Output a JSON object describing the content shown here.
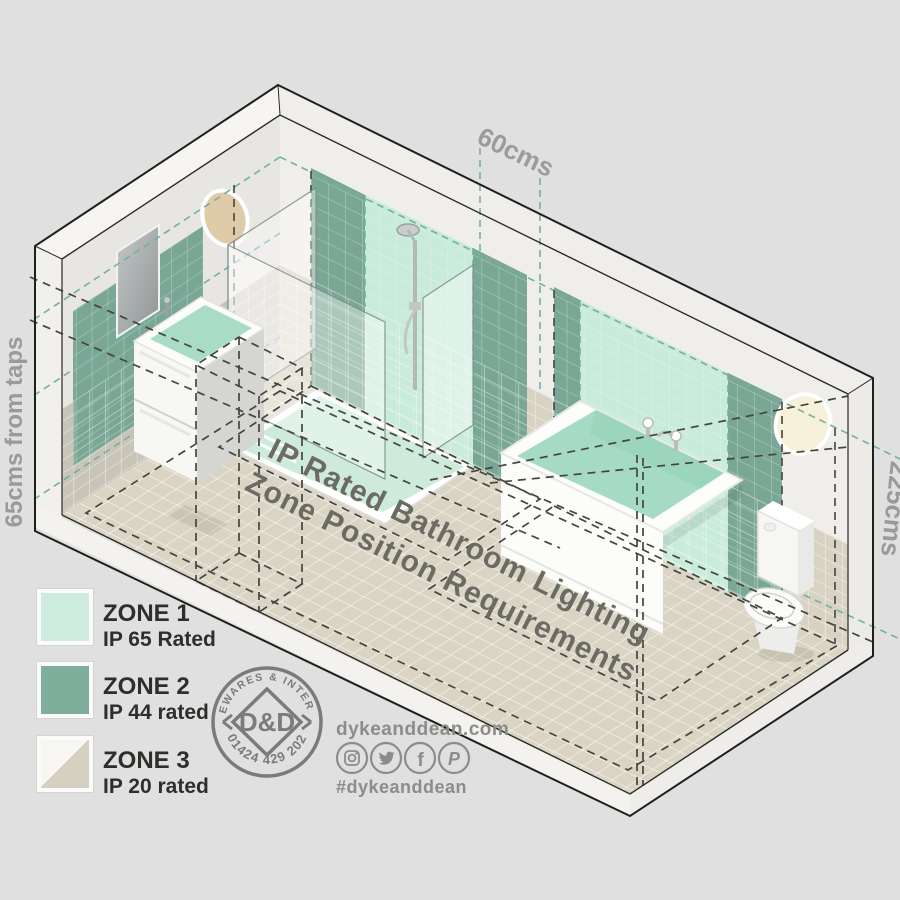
{
  "scene": {
    "floor_title_line1": "IP Rated Bathroom Lighting",
    "floor_title_line2": "Zone Position Requirements",
    "dim_top": "60cms",
    "dim_left": "65cms from taps",
    "dim_right": "225cms"
  },
  "legend": {
    "zones": [
      {
        "label": "ZONE 1",
        "rating": "IP 65 Rated",
        "color": "#cdebdf"
      },
      {
        "label": "ZONE 2",
        "rating": "IP 44 rated",
        "color": "#7fae9c"
      },
      {
        "label": "ZONE 3",
        "rating": "IP 20 rated",
        "color_top": "#f7f6f3",
        "color_bottom": "#d5d0c2"
      }
    ]
  },
  "logo": {
    "arc_top": "HOMEWARES & INTERIORS",
    "monogram": "D&D",
    "arc_bottom": "01424 429 202"
  },
  "social": {
    "website": "dykeanddean.com",
    "hashtag": "#dykeanddean",
    "icons": [
      "instagram-icon",
      "twitter-icon",
      "facebook-icon",
      "pinterest-icon"
    ]
  },
  "colors": {
    "background": "#e0e0e0",
    "zone1": "#c8ebdb",
    "zone2": "#7aa795",
    "floor": "#d9d4c3",
    "wall_left": "#e7e6e3",
    "wall_right": "#efeeeb",
    "tile_band_left": "#c9c4b8",
    "tile_band_right": "#d8d2c2",
    "structure": "#f4f3f0",
    "dash_dark": "#45453f",
    "dash_teal": "#74b0a0",
    "label_gray": "#9b9b9b",
    "title_gray": "#6b6b64",
    "brand_gray": "#7b7b79",
    "social_gray": "#8c8c8a",
    "legend_text": "#2e2e2b"
  }
}
